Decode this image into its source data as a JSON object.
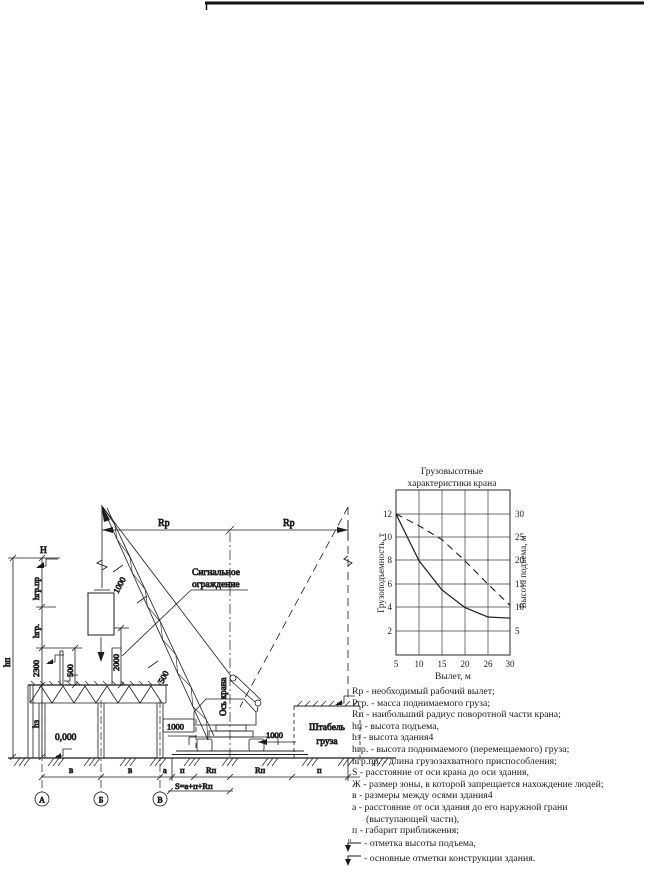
{
  "page": {
    "background": "#ffffff",
    "ink": "#1c1c1c"
  },
  "drawing": {
    "labels": {
      "rp_left": "Rp",
      "rp_right": "Rp",
      "h_mark": "Н",
      "hgr_pr": "hгр.пр",
      "hgr": "hгр.",
      "dim_2300": "2300",
      "hz": "hз",
      "hp": "hп",
      "dim_500_rail": "500",
      "dim_500_boom": "500",
      "dim_2000": "2000",
      "dim_1000_boom": "1000",
      "dim_1000_left": "1000",
      "dim_1000_right": "1000",
      "signal_line1": "Сигнальное",
      "signal_line2": "ограждение",
      "crane_axis": "Ось крана",
      "zero_mark": "0,000",
      "stack_line1": "Штабель",
      "stack_line2": "груза",
      "axis_a": "А",
      "axis_b": "Б",
      "axis_v": "В",
      "dim_v1": "в",
      "dim_v2": "в",
      "dim_a": "а",
      "dim_p1": "п",
      "dim_rp1": "Rп",
      "dim_rp2": "Rп",
      "dim_p2": "п",
      "s_formula": "S=а+п+Rп"
    }
  },
  "chart": {
    "title_line1": "Грузовысотные",
    "title_line2": "характеристики крана",
    "ylabel_left": "Грузоподъемность, т",
    "ylabel_right": "Высота подъема, м",
    "xlabel": "Вылет, м",
    "left_ticks": [
      "12",
      "10",
      "8",
      "6",
      "4",
      "2"
    ],
    "right_ticks": [
      "30",
      "25",
      "20",
      "15",
      "10",
      "5"
    ],
    "x_ticks": [
      "5",
      "10",
      "15",
      "20",
      "26",
      "30"
    ]
  },
  "chart_data": {
    "type": "line",
    "title": "Грузовысотные характеристики крана",
    "xlabel": "Вылет, м",
    "ylabel_left": "Грузоподъемность, т",
    "ylabel_right": "Высота подъема, м",
    "x": [
      5,
      10,
      15,
      20,
      26,
      30
    ],
    "series": [
      {
        "name": "Грузоподъемность, т",
        "axis": "left",
        "style": "solid",
        "values": [
          12,
          8,
          5.5,
          4,
          3.2,
          3.1
        ]
      },
      {
        "name": "Высота подъема, м",
        "axis": "right",
        "style": "dashed",
        "values": [
          30,
          27.5,
          24.5,
          20,
          15,
          10.5
        ]
      }
    ],
    "ylim_left": [
      0,
      14
    ],
    "ylim_right": [
      0,
      35
    ],
    "xlim": [
      5,
      30
    ],
    "grid": true,
    "legend_position": "none"
  },
  "legend": {
    "items": [
      "Rp - необходимый рабочий вылет;",
      "Ргр. - масса поднимаемого груза;",
      "Rп - наибольший радиус поворотной части крана;",
      "hп - высота подъема,",
      "hз - высота здания4",
      "hгр. - высота поднимаемого (перемещаемого) груза;",
      "hгр.пр. - длина грузозахватного приспособления;",
      "S - расстояние от оси крана до оси здания,",
      "Ж - размер зоны, в которой запрещается нахождение людей;",
      "в - размеры между осями здания4",
      "а - расстояние от оси здания до его наружной грани (выступающей части),",
      "п - габарит приближения;"
    ],
    "mark_items": [
      {
        "symbol": "elevation-height-mark",
        "sup": "н",
        "label": "- отметка высоты подъема,"
      },
      {
        "symbol": "building-elevation-mark",
        "sup": "",
        "label": "- основные отметки конструкции здания."
      }
    ]
  }
}
